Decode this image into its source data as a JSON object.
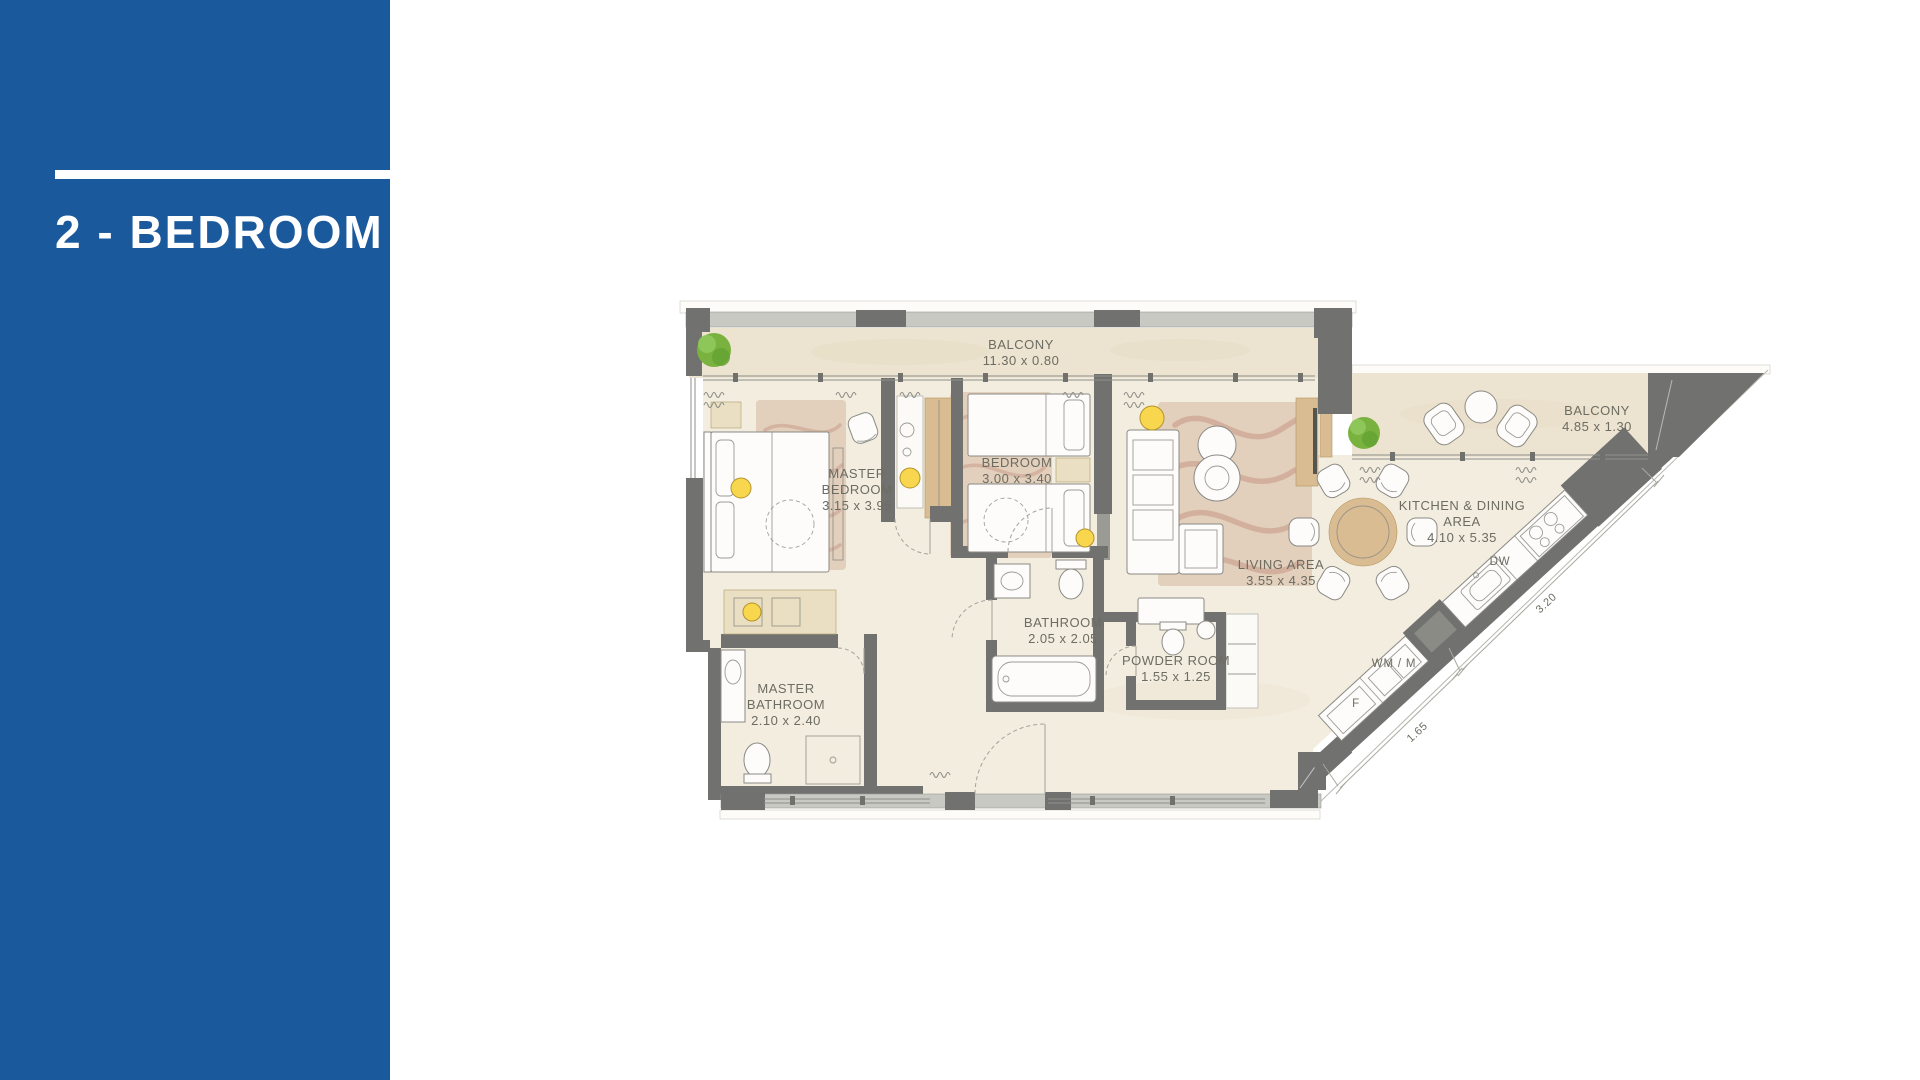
{
  "sidebar": {
    "title": "2 - BEDROOM"
  },
  "plan": {
    "rooms": [
      {
        "name": "BALCONY",
        "dims": "11.30 x 0.80"
      },
      {
        "name": "MASTER BEDROOM",
        "dims": "3.15 x 3.95"
      },
      {
        "name": "BEDROOM",
        "dims": "3.00 x 3.40"
      },
      {
        "name": "LIVING AREA",
        "dims": "3.55 x 4.35"
      },
      {
        "name": "KITCHEN & DINING AREA",
        "dims": "4.10 x 5.35"
      },
      {
        "name": "BALCONY",
        "dims": "4.85 x 1.30"
      },
      {
        "name": "BATHROOM",
        "dims": "2.05 x 2.05"
      },
      {
        "name": "POWDER ROOM",
        "dims": "1.55 x 1.25"
      },
      {
        "name": "MASTER BATHROOM",
        "dims": "2.10 x 2.40"
      }
    ],
    "appliances": [
      {
        "label": "DW"
      },
      {
        "label": "WM / M"
      },
      {
        "label": "F"
      }
    ],
    "dim_labels": [
      {
        "label": "3.20"
      },
      {
        "label": "1.65"
      }
    ]
  },
  "colors": {
    "accent": "#1a5a9c",
    "wall": "#717170",
    "wall_light": "#c9c9c4",
    "floor": "#f3eddf",
    "balcony_floor": "#ece3d0",
    "rug": "#e0cbb8",
    "rug_stroke": "#c4917e",
    "wood": "#d9bc92",
    "wood_light": "#eadfc2",
    "plant": "#79b23f",
    "light_fill": "#f8d64e",
    "label": "#6c6c62",
    "outline": "#8a8a85"
  }
}
